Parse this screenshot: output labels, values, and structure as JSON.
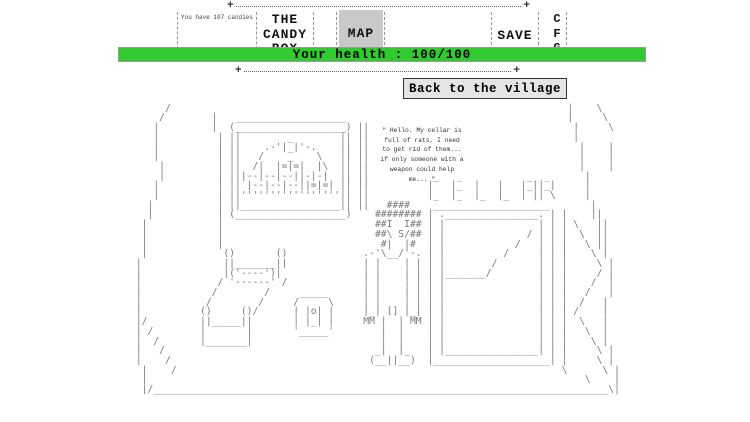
{
  "header": {
    "border_plus": "+",
    "candies_label": "You have 107 candies",
    "title_lines": [
      "THE",
      "CANDY",
      "BOX"
    ],
    "map_label": "MAP",
    "save_label": "SAVE",
    "cfg_letters": [
      "C",
      "F",
      "G"
    ],
    "map_button_bg": "#c9c9c9",
    "health_label": "Your health : 100/100",
    "health_color": "#2fcb2f"
  },
  "village_button": {
    "label": "Back to the village"
  },
  "scene": {
    "cellar_label": "CELLAR",
    "speech_lines": [
      "\" Hello. My cellar is",
      "full of rats, I need",
      "to get rid of them...",
      "if only someone with a",
      "weapon could help",
      "me... \""
    ],
    "art": [
      [
        [
          6,
          "/"
        ],
        [
          75,
          "|"
        ],
        [
          80,
          "\\"
        ]
      ],
      [
        [
          5,
          "/"
        ],
        [
          14,
          "|"
        ],
        [
          18,
          "___________________"
        ],
        [
          75,
          "|"
        ],
        [
          81,
          "\\"
        ]
      ],
      [
        [
          4,
          "|"
        ],
        [
          14,
          "|"
        ],
        [
          17,
          "(___________________)"
        ],
        [
          39,
          "||"
        ],
        [
          76,
          "|"
        ],
        [
          82,
          "\\"
        ]
      ],
      [
        [
          4,
          "|"
        ],
        [
          15,
          "|"
        ],
        [
          17,
          "||"
        ],
        [
          27,
          "_"
        ],
        [
          36,
          "||"
        ],
        [
          39,
          "||"
        ],
        [
          76,
          "|"
        ]
      ],
      [
        [
          4,
          "|"
        ],
        [
          15,
          "|"
        ],
        [
          17,
          "||"
        ],
        [
          23,
          ".-'|_|'-."
        ],
        [
          36,
          "||"
        ],
        [
          39,
          "||"
        ],
        [
          77,
          "|"
        ],
        [
          82,
          "|"
        ]
      ],
      [
        [
          4,
          "|"
        ],
        [
          15,
          "|"
        ],
        [
          17,
          "||"
        ],
        [
          22,
          "/"
        ],
        [
          27,
          "_"
        ],
        [
          32,
          "\\"
        ],
        [
          36,
          "||"
        ],
        [
          39,
          "||"
        ],
        [
          77,
          "|"
        ],
        [
          82,
          "|"
        ]
      ],
      [
        [
          5,
          "|"
        ],
        [
          15,
          "|"
        ],
        [
          17,
          "||"
        ],
        [
          21,
          "/|"
        ],
        [
          25,
          "|=|=|"
        ],
        [
          32,
          "|\\"
        ],
        [
          36,
          "||"
        ],
        [
          39,
          "||"
        ],
        [
          77,
          "|"
        ],
        [
          82,
          "|"
        ]
      ],
      [
        [
          5,
          "|"
        ],
        [
          15,
          "|"
        ],
        [
          17,
          "||"
        ],
        [
          19,
          "|--|--|--|"
        ],
        [
          29,
          "|-|-|"
        ],
        [
          36,
          "||"
        ],
        [
          39,
          "||"
        ],
        [
          52,
          "_"
        ],
        [
          56,
          "_"
        ],
        [
          68,
          "_"
        ],
        [
          71,
          "_"
        ],
        [
          78,
          "|"
        ]
      ],
      [
        [
          4,
          "|"
        ],
        [
          15,
          "|"
        ],
        [
          17,
          "||"
        ],
        [
          20,
          "|--|--|--|"
        ],
        [
          30,
          "|=|=|"
        ],
        [
          36,
          "||"
        ],
        [
          39,
          "||"
        ],
        [
          51,
          "|"
        ],
        [
          55,
          "|_"
        ],
        [
          59,
          "|"
        ],
        [
          63,
          "|"
        ],
        [
          67,
          "|_|"
        ],
        [
          70,
          "|_|"
        ],
        [
          78,
          "|"
        ]
      ],
      [
        [
          4,
          "|"
        ],
        [
          15,
          "|"
        ],
        [
          17,
          "||"
        ],
        [
          19,
          "'''''''''''''''''"
        ],
        [
          36,
          "||"
        ],
        [
          39,
          "||"
        ],
        [
          51,
          "|_"
        ],
        [
          55,
          "|_"
        ],
        [
          59,
          "|_"
        ],
        [
          63,
          "|_"
        ],
        [
          67,
          "|"
        ],
        [
          69,
          "||"
        ],
        [
          72,
          "\\"
        ],
        [
          78,
          "|"
        ]
      ],
      [
        [
          3,
          "|"
        ],
        [
          15,
          "|"
        ],
        [
          17,
          "||"
        ],
        [
          19,
          "_________________"
        ],
        [
          36,
          "||"
        ],
        [
          39,
          "||"
        ],
        [
          44,
          "####"
        ],
        [
          52,
          "____________________"
        ],
        [
          79,
          "|"
        ]
      ],
      [
        [
          3,
          "|"
        ],
        [
          15,
          "|"
        ],
        [
          17,
          "(___________________)"
        ],
        [
          42,
          "########"
        ],
        [
          51,
          "|"
        ],
        [
          53,
          ".________________."
        ],
        [
          72,
          "|"
        ],
        [
          74,
          "|"
        ],
        [
          79,
          "||"
        ]
      ],
      [
        [
          2,
          "|"
        ],
        [
          15,
          "|"
        ],
        [
          42,
          "##I  I##"
        ],
        [
          51,
          "|"
        ],
        [
          53,
          "|"
        ],
        [
          70,
          "|"
        ],
        [
          72,
          "|"
        ],
        [
          74,
          "|"
        ],
        [
          76,
          "\\"
        ],
        [
          80,
          "||"
        ]
      ],
      [
        [
          2,
          "|"
        ],
        [
          15,
          "|"
        ],
        [
          42,
          "##\\ S/##"
        ],
        [
          51,
          "|"
        ],
        [
          53,
          "|"
        ],
        [
          68,
          "/"
        ],
        [
          70,
          "|"
        ],
        [
          72,
          "|"
        ],
        [
          74,
          "|"
        ],
        [
          77,
          "\\"
        ],
        [
          80,
          "||"
        ]
      ],
      [
        [
          2,
          "|"
        ],
        [
          15,
          "|"
        ],
        [
          43,
          "#|  |#"
        ],
        [
          51,
          "|"
        ],
        [
          53,
          "|"
        ],
        [
          66,
          "/"
        ],
        [
          70,
          "|"
        ],
        [
          72,
          "|"
        ],
        [
          74,
          "|"
        ],
        [
          78,
          "\\"
        ],
        [
          80,
          "||"
        ]
      ],
      [
        [
          2,
          "|"
        ],
        [
          16,
          "()"
        ],
        [
          25,
          "()"
        ],
        [
          40,
          ".-'\\__/'-."
        ],
        [
          51,
          "|"
        ],
        [
          53,
          "|"
        ],
        [
          64,
          "/"
        ],
        [
          70,
          "|"
        ],
        [
          72,
          "|"
        ],
        [
          74,
          "|"
        ],
        [
          79,
          "\\"
        ],
        [
          81,
          "|"
        ]
      ],
      [
        [
          1,
          "|"
        ],
        [
          16,
          "||"
        ],
        [
          18,
          "_______"
        ],
        [
          25,
          "||"
        ],
        [
          40,
          "|"
        ],
        [
          42,
          "|"
        ],
        [
          47,
          "|"
        ],
        [
          49,
          "|"
        ],
        [
          51,
          "|"
        ],
        [
          53,
          "|"
        ],
        [
          62,
          "/"
        ],
        [
          70,
          "|"
        ],
        [
          72,
          "|"
        ],
        [
          74,
          "|"
        ],
        [
          80,
          "\\"
        ],
        [
          82,
          "|"
        ]
      ],
      [
        [
          1,
          "|"
        ],
        [
          16,
          "|"
        ],
        [
          17,
          "('----')"
        ],
        [
          25,
          "|"
        ],
        [
          40,
          "|"
        ],
        [
          42,
          "|"
        ],
        [
          47,
          "|"
        ],
        [
          49,
          "|"
        ],
        [
          51,
          "|"
        ],
        [
          53,
          "|"
        ],
        [
          54,
          "_______"
        ],
        [
          61,
          "/"
        ],
        [
          70,
          "|"
        ],
        [
          72,
          "|"
        ],
        [
          74,
          "|"
        ],
        [
          80,
          "/"
        ],
        [
          82,
          "|"
        ]
      ],
      [
        [
          1,
          "|"
        ],
        [
          15,
          "/"
        ],
        [
          17,
          "'------'"
        ],
        [
          26,
          "/"
        ],
        [
          40,
          "|"
        ],
        [
          42,
          "|"
        ],
        [
          47,
          "|"
        ],
        [
          49,
          "|"
        ],
        [
          51,
          "|"
        ],
        [
          53,
          "|"
        ],
        [
          70,
          "|"
        ],
        [
          72,
          "|"
        ],
        [
          74,
          "|"
        ],
        [
          79,
          "/"
        ],
        [
          82,
          "|"
        ]
      ],
      [
        [
          1,
          "|"
        ],
        [
          14,
          "/"
        ],
        [
          23,
          "/"
        ],
        [
          29,
          "_____"
        ],
        [
          40,
          "|"
        ],
        [
          42,
          "|"
        ],
        [
          47,
          "|"
        ],
        [
          49,
          "|"
        ],
        [
          51,
          "|"
        ],
        [
          53,
          "|"
        ],
        [
          70,
          "|"
        ],
        [
          72,
          "|"
        ],
        [
          74,
          "|"
        ],
        [
          78,
          "/"
        ],
        [
          82,
          "|"
        ]
      ],
      [
        [
          1,
          "|"
        ],
        [
          13,
          "/"
        ],
        [
          22,
          "/"
        ],
        [
          28,
          "/"
        ],
        [
          34,
          "\\"
        ],
        [
          40,
          "|"
        ],
        [
          42,
          "|"
        ],
        [
          47,
          "|"
        ],
        [
          49,
          "|"
        ],
        [
          51,
          "|"
        ],
        [
          53,
          "|"
        ],
        [
          70,
          "|"
        ],
        [
          72,
          "|"
        ],
        [
          74,
          "|"
        ],
        [
          77,
          "/"
        ],
        [
          81,
          "|"
        ]
      ],
      [
        [
          1,
          "|"
        ],
        [
          12,
          "()"
        ],
        [
          19,
          "()"
        ],
        [
          21,
          "/"
        ],
        [
          28,
          "|"
        ],
        [
          30,
          "|o|"
        ],
        [
          34,
          "|"
        ],
        [
          40,
          "|_|"
        ],
        [
          44,
          "[]"
        ],
        [
          47,
          "|_|"
        ],
        [
          51,
          "|"
        ],
        [
          53,
          "|"
        ],
        [
          70,
          "|"
        ],
        [
          72,
          "|"
        ],
        [
          74,
          "|"
        ],
        [
          76,
          "/"
        ],
        [
          81,
          "|"
        ]
      ],
      [
        [
          1,
          "|"
        ],
        [
          2,
          "/"
        ],
        [
          12,
          "||"
        ],
        [
          14,
          "_____"
        ],
        [
          19,
          "||"
        ],
        [
          28,
          "|"
        ],
        [
          30,
          "|_|"
        ],
        [
          34,
          "|"
        ],
        [
          40,
          "MM"
        ],
        [
          43,
          "|"
        ],
        [
          46,
          "|"
        ],
        [
          48,
          "MM"
        ],
        [
          51,
          "|"
        ],
        [
          53,
          "|"
        ],
        [
          70,
          "|"
        ],
        [
          72,
          "|"
        ],
        [
          74,
          "|"
        ],
        [
          77,
          "\\"
        ],
        [
          81,
          "|"
        ]
      ],
      [
        [
          1,
          "|"
        ],
        [
          3,
          "/"
        ],
        [
          12,
          "|"
        ],
        [
          20,
          "|"
        ],
        [
          28,
          "'_____'"
        ],
        [
          43,
          "|"
        ],
        [
          46,
          "|"
        ],
        [
          51,
          "|"
        ],
        [
          53,
          "|"
        ],
        [
          70,
          "|"
        ],
        [
          72,
          "|"
        ],
        [
          74,
          "|"
        ],
        [
          78,
          "\\"
        ],
        [
          81,
          "|"
        ]
      ],
      [
        [
          1,
          "|"
        ],
        [
          4,
          "/"
        ],
        [
          12,
          "|"
        ],
        [
          13,
          "_______"
        ],
        [
          20,
          "|"
        ],
        [
          43,
          "|"
        ],
        [
          46,
          "|"
        ],
        [
          51,
          "|"
        ],
        [
          53,
          "|"
        ],
        [
          70,
          "|"
        ],
        [
          72,
          "|"
        ],
        [
          74,
          "|"
        ],
        [
          79,
          "\\"
        ],
        [
          81,
          "|"
        ]
      ],
      [
        [
          1,
          "|"
        ],
        [
          5,
          "/"
        ],
        [
          42,
          "_|"
        ],
        [
          46,
          "|_"
        ],
        [
          51,
          "|"
        ],
        [
          53,
          "|"
        ],
        [
          54,
          "________________"
        ],
        [
          70,
          "|"
        ],
        [
          72,
          "|"
        ],
        [
          74,
          "|"
        ],
        [
          80,
          "\\"
        ],
        [
          82,
          "|"
        ]
      ],
      [
        [
          1,
          "|"
        ],
        [
          6,
          "/"
        ],
        [
          41,
          "(__||__)"
        ],
        [
          51,
          "|____________________|"
        ],
        [
          74,
          "|"
        ],
        [
          80,
          "\\"
        ],
        [
          82,
          "|"
        ]
      ],
      [
        [
          2,
          "|"
        ],
        [
          7,
          "/"
        ],
        [
          74,
          "\\"
        ],
        [
          81,
          "\\"
        ],
        [
          83,
          "|"
        ]
      ],
      [
        [
          2,
          "|"
        ],
        [
          78,
          "\\"
        ],
        [
          83,
          "|"
        ]
      ],
      [
        [
          2,
          "|/"
        ],
        [
          4,
          "______________________________________________________________________________"
        ],
        [
          82,
          "\\|"
        ]
      ]
    ]
  }
}
